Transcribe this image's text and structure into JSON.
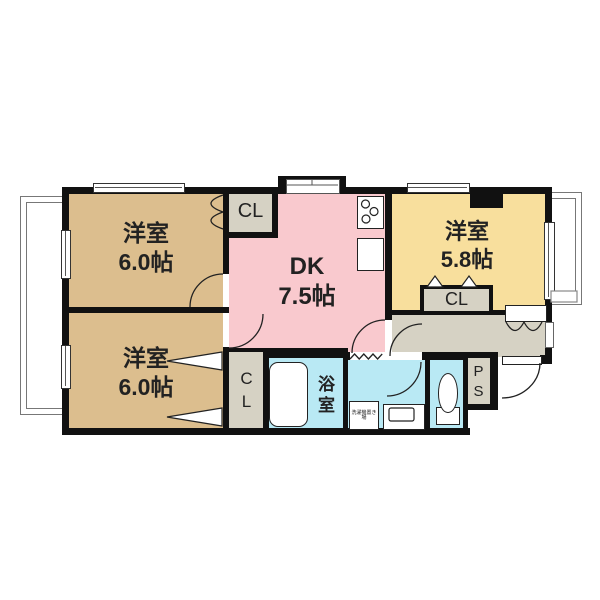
{
  "floorplan": {
    "rooms": {
      "western_top_left": {
        "label": "洋室",
        "area": "6.0帖"
      },
      "western_bottom_left": {
        "label": "洋室",
        "area": "6.0帖"
      },
      "dk": {
        "label": "DK",
        "area": "7.5帖"
      },
      "western_right": {
        "label": "洋室",
        "area": "5.8帖"
      },
      "bathroom": {
        "label": "浴室"
      }
    },
    "closets": {
      "top": {
        "label": "CL"
      },
      "bottom": {
        "label": "CL"
      },
      "right": {
        "label": "CL"
      }
    },
    "utility": {
      "pipe_space": {
        "label": "PS"
      },
      "laundry_space": {
        "label": "洗濯機置き場"
      }
    },
    "colors": {
      "western_room": "#DCBE8E",
      "dk": "#F9C9CE",
      "right_room": "#F8DF9D",
      "wet_area": "#B9E9F4",
      "closet": "#D6D2C4",
      "wall": "#111111"
    }
  }
}
